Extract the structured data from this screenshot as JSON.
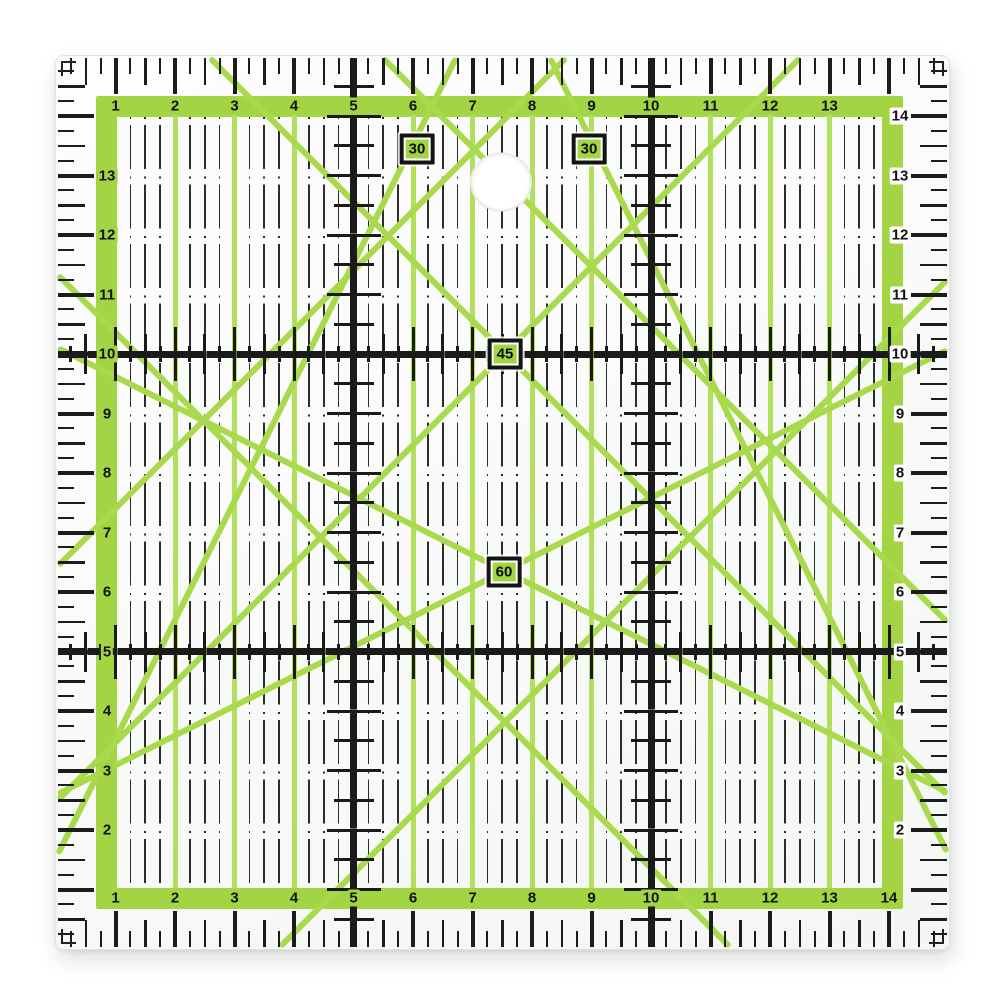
{
  "ruler": {
    "scales": {
      "top": [
        "1",
        "2",
        "3",
        "4",
        "5",
        "6",
        "7",
        "8",
        "9",
        "10",
        "11",
        "12",
        "13"
      ],
      "bottom": [
        "1",
        "2",
        "3",
        "4",
        "5",
        "6",
        "7",
        "8",
        "9",
        "10",
        "11",
        "12",
        "13",
        "14"
      ],
      "left": [
        "13",
        "12",
        "11",
        "10",
        "9",
        "8",
        "7",
        "6",
        "5",
        "4",
        "3",
        "2"
      ],
      "right": [
        "14",
        "13",
        "12",
        "11",
        "10",
        "9",
        "8",
        "7",
        "6",
        "5",
        "4",
        "3",
        "2"
      ]
    },
    "major_grid_labels": [
      "5",
      "10"
    ],
    "angle_markers": [
      {
        "label": "30"
      },
      {
        "label": "30"
      },
      {
        "label": "45"
      },
      {
        "label": "60"
      }
    ],
    "colors": {
      "band_green": "#a2d443",
      "grid_green": "#b2df5e",
      "diagonal_green": "#a9da4e",
      "print_black": "#1a1a1a",
      "body_white": "#fcfdfc",
      "hole_ring": "#ebebeb"
    }
  }
}
